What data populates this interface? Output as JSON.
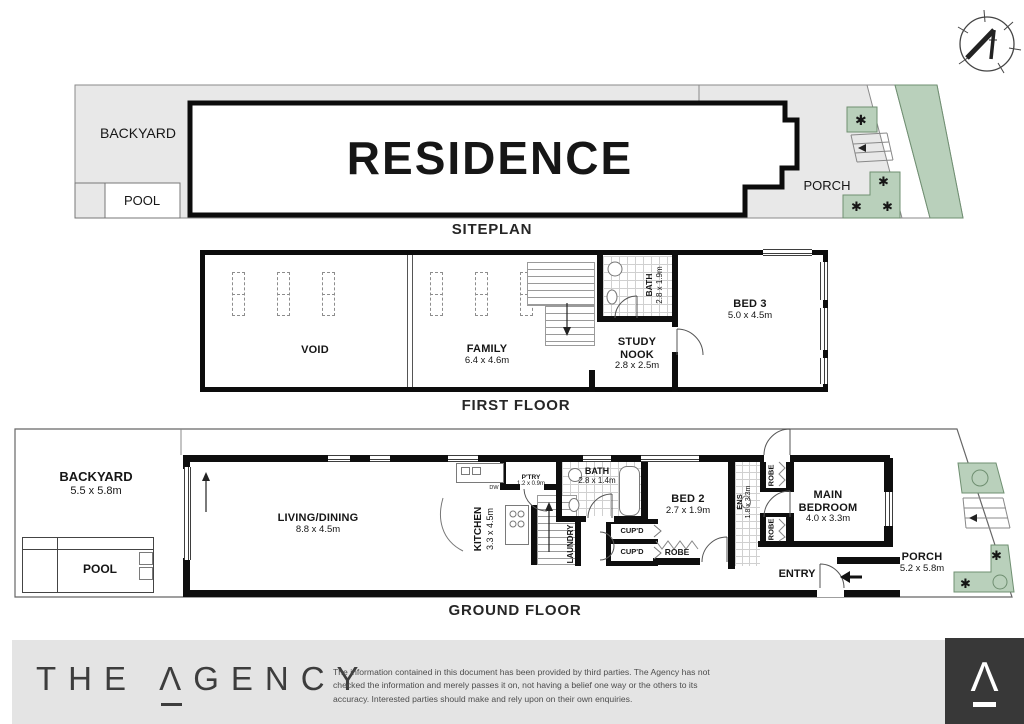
{
  "siteplan": {
    "title": "SITEPLAN",
    "backyard": "BACKYARD",
    "pool": "POOL",
    "residence": "RESIDENCE",
    "porch": "PORCH"
  },
  "ff": {
    "title": "FIRST FLOOR",
    "void": "VOID",
    "family": "FAMILY",
    "family_dims": "6.4 x 4.6m",
    "bath": "BATH",
    "bath_dims": "2.8 x 1.9m",
    "study1": "STUDY",
    "study2": "NOOK",
    "study_dims": "2.8 x 2.5m",
    "bed3": "BED 3",
    "bed3_dims": "5.0 x 4.5m"
  },
  "gf": {
    "title": "GROUND FLOOR",
    "backyard": "BACKYARD",
    "backyard_dims": "5.5 x 5.8m",
    "pool": "POOL",
    "living": "LIVING/DINING",
    "living_dims": "8.8 x 4.5m",
    "kitchen": "KITCHEN",
    "kitchen_dims": "3.3 x 4.5m",
    "pantry": "P'TRY",
    "pantry_dims": "1.2 x 0.9m",
    "dw": "DW",
    "bath": "BATH",
    "bath_dims": "2.8 x 1.4m",
    "laundry": "LAUNDRY",
    "cupd": [
      "CUP'D",
      "CUP'D"
    ],
    "bed2": "BED 2",
    "bed2_dims": "2.7 x 1.9m",
    "robes": [
      "ROBE",
      "ROBE",
      "ROBE"
    ],
    "ens": "ENS",
    "ens_dims": "1.8 x 3.3m",
    "main1": "MAIN",
    "main2": "BEDROOM",
    "main_dims": "4.0 x 3.3m",
    "entry": "ENTRY",
    "porch": "PORCH",
    "porch_dims": "5.2 x 5.8m"
  },
  "footer": {
    "brand_the": "THE",
    "brand_a": "Λ",
    "brand_rest": "GENCY",
    "logo_glyph": "Λ",
    "disclaimer": "The information contained in this document has been provided by third parties. The Agency has not checked the information and merely passes it on, not having a belief one way or the others to its accuracy. Interested parties should make and rely upon on their own enquiries."
  },
  "icons": {
    "plant": "✱"
  },
  "colors": {
    "site_gray": "#e8e8e8",
    "wall_black": "#0e0e0e",
    "green_fill": "#b9d0bb",
    "green_stroke": "#6f8f71",
    "plant_green": "#4d8f42",
    "footer_gray": "#e4e4e4",
    "footer_dark": "#383838"
  }
}
